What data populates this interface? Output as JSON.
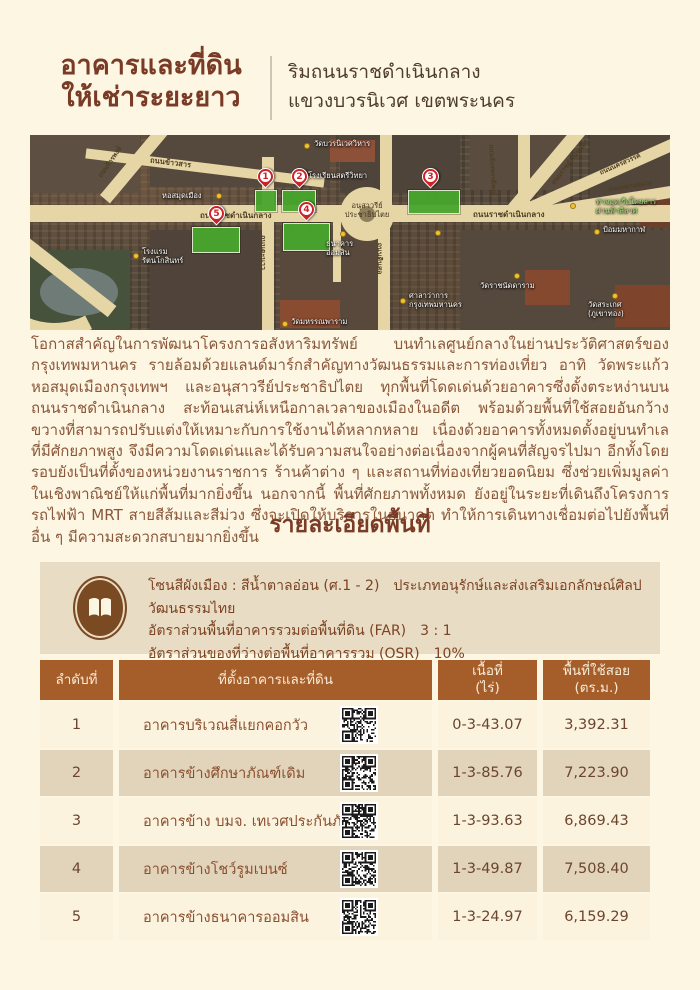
{
  "page": {
    "title_line1": "อาคารและที่ดิน",
    "title_line2": "ให้เช่าระยะยาว",
    "subtitle_line1": "ริมถนนราชดำเนินกลาง",
    "subtitle_line2": "แขวงบวรนิเวศ เขตพระนคร"
  },
  "map": {
    "road_labels": [
      {
        "text": "ถนนข้าวสาร"
      },
      {
        "text": "ถนนตะนาว"
      },
      {
        "text": "ถนนดินสอ"
      },
      {
        "text": "ถนนราชดำเนินกลาง"
      },
      {
        "text": "ถนนราชดำเนินกลาง"
      },
      {
        "text": "ถนนจักรพรรดิพงษ์"
      },
      {
        "text": "ถนนราชดำเนินนอก"
      },
      {
        "text": "ถนนนครสวรรค์"
      },
      {
        "text": "ถนนหลานหลวง"
      },
      {
        "text": "ถนนจักรพงษ์"
      }
    ],
    "poi_labels": [
      {
        "text": "วัดบวรนิเวศวิหาร"
      },
      {
        "text": "โรงเรียนสตรีวิทยา"
      },
      {
        "text": "หอสมุดเมือง"
      },
      {
        "text": "อนุสาวรีย์\nประชาธิปไตย"
      },
      {
        "text": "โรงแรม\nรัตนโกสินทร์"
      },
      {
        "text": "ธนาคาร\nออมสิน"
      },
      {
        "text": "วัดมหรรณพาราม"
      },
      {
        "text": "ศาลาว่าการ\nกรุงเทพมหานคร"
      },
      {
        "text": "วัดราชนัดดาราม"
      },
      {
        "text": "วัดสระเกศ\n(ภูเขาทอง)"
      },
      {
        "text": "ป้อมมหากาฬ"
      },
      {
        "text": "ท่าจอดเรือโดยสาร\nผ่านฟ้าลีลาศ"
      }
    ],
    "markers": [
      {
        "number": "1"
      },
      {
        "number": "2"
      },
      {
        "number": "3"
      },
      {
        "number": "4"
      },
      {
        "number": "5"
      }
    ]
  },
  "intro": {
    "paragraph": "โอกาสสำคัญในการพัฒนาโครงการอสังหาริมทรัพย์ บนทำเลศูนย์กลางในย่านประวัติศาสตร์ของกรุงเทพมหานคร รายล้อมด้วยแลนด์มาร์กสำคัญทางวัฒนธรรมและการท่องเที่ยว อาทิ วัดพระแก้ว หอสมุดเมืองกรุงเทพฯ และอนุสาวรีย์ประชาธิปไตย ทุกพื้นที่โดดเด่นด้วยอาคารซึ่งตั้งตระหง่านบนถนนราชดำเนินกลาง สะท้อนเสน่ห์เหนือกาลเวลาของเมืองในอดีต พร้อมด้วยพื้นที่ใช้สอยอันกว้างขวางที่สามารถปรับแต่งให้เหมาะกับการใช้งานได้หลากหลาย เนื่องด้วยอาคารทั้งหมดตั้งอยู่บนทำเลที่มีศักยภาพสูง จึงมีความโดดเด่นและได้รับความสนใจอย่างต่อเนื่องจากผู้คนที่สัญจรไปมา อีกทั้งโดยรอบยังเป็นที่ตั้งของหน่วยงานราชการ ร้านค้าต่าง ๆ และสถานที่ท่องเที่ยวยอดนิยม ซึ่งช่วยเพิ่มมูลค่าในเชิงพาณิชย์ให้แก่พื้นที่มากยิ่งขึ้น นอกจากนี้ พื้นที่ศักยภาพทั้งหมด ยังอยู่ในระยะที่เดินถึงโครงการรถไฟฟ้า MRT สายสีส้มและสีม่วง ซึ่งจะเปิดให้บริการในอนาคต ทำให้การเดินทางเชื่อมต่อไปยังพื้นที่อื่น ๆ มีความสะดวกสบายมากยิ่งขึ้น"
  },
  "details": {
    "section_title": "รายละเอียดพื้นที่",
    "zone_line1_label": "โซนสีผังเมือง : สีน้ำตาลอ่อน (ศ.1 - 2)",
    "zone_line1_desc": "ประเภทอนุรักษ์และส่งเสริมเอกลักษณ์ศิลปวัฒนธรรมไทย",
    "far_label": "อัตราส่วนพื้นที่อาคารรวมต่อพื้นที่ดิน (FAR)",
    "far_value": "3 : 1",
    "osr_label": "อัตราส่วนของที่ว่างต่อพื้นที่อาคารรวม (OSR)",
    "osr_value": "10%"
  },
  "table": {
    "headers": {
      "no": "ลำดับที่",
      "location": "ที่ตั้งอาคารและที่ดิน",
      "area": "เนื้อที่",
      "area_unit": "(ไร่)",
      "usable": "พื้นที่ใช้สอย",
      "usable_unit": "(ตร.ม.)"
    },
    "rows": [
      {
        "no": "1",
        "name": "อาคารบริเวณสี่แยกคอกวัว",
        "area": "0-3-43.07",
        "usable": "3,392.31"
      },
      {
        "no": "2",
        "name": "อาคารข้างศึกษาภัณฑ์เดิม",
        "area": "1-3-85.76",
        "usable": "7,223.90"
      },
      {
        "no": "3",
        "name": "อาคารข้าง บมจ. เทเวศประกันภัย",
        "area": "1-3-93.63",
        "usable": "6,869.43"
      },
      {
        "no": "4",
        "name": "อาคารข้างโชว์รูมเบนซ์",
        "area": "1-3-49.87",
        "usable": "7,508.40"
      },
      {
        "no": "5",
        "name": "อาคารข้างธนาคารออมสิน",
        "area": "1-3-24.97",
        "usable": "6,159.29"
      }
    ]
  },
  "colors": {
    "page_bg": "#fdf6e2",
    "title_text": "#793a26",
    "body_text": "#8a573a",
    "table_header_bg": "#a55d2a",
    "row_light": "#fbf3de",
    "row_dark": "#e2d4ba",
    "info_box_bg": "#e9dcc4",
    "parcel_green": "#48a52c",
    "pin_red": "#ce2127",
    "road_tan": "#e6d6a6",
    "poi_dot_yellow": "#f2c12e"
  }
}
